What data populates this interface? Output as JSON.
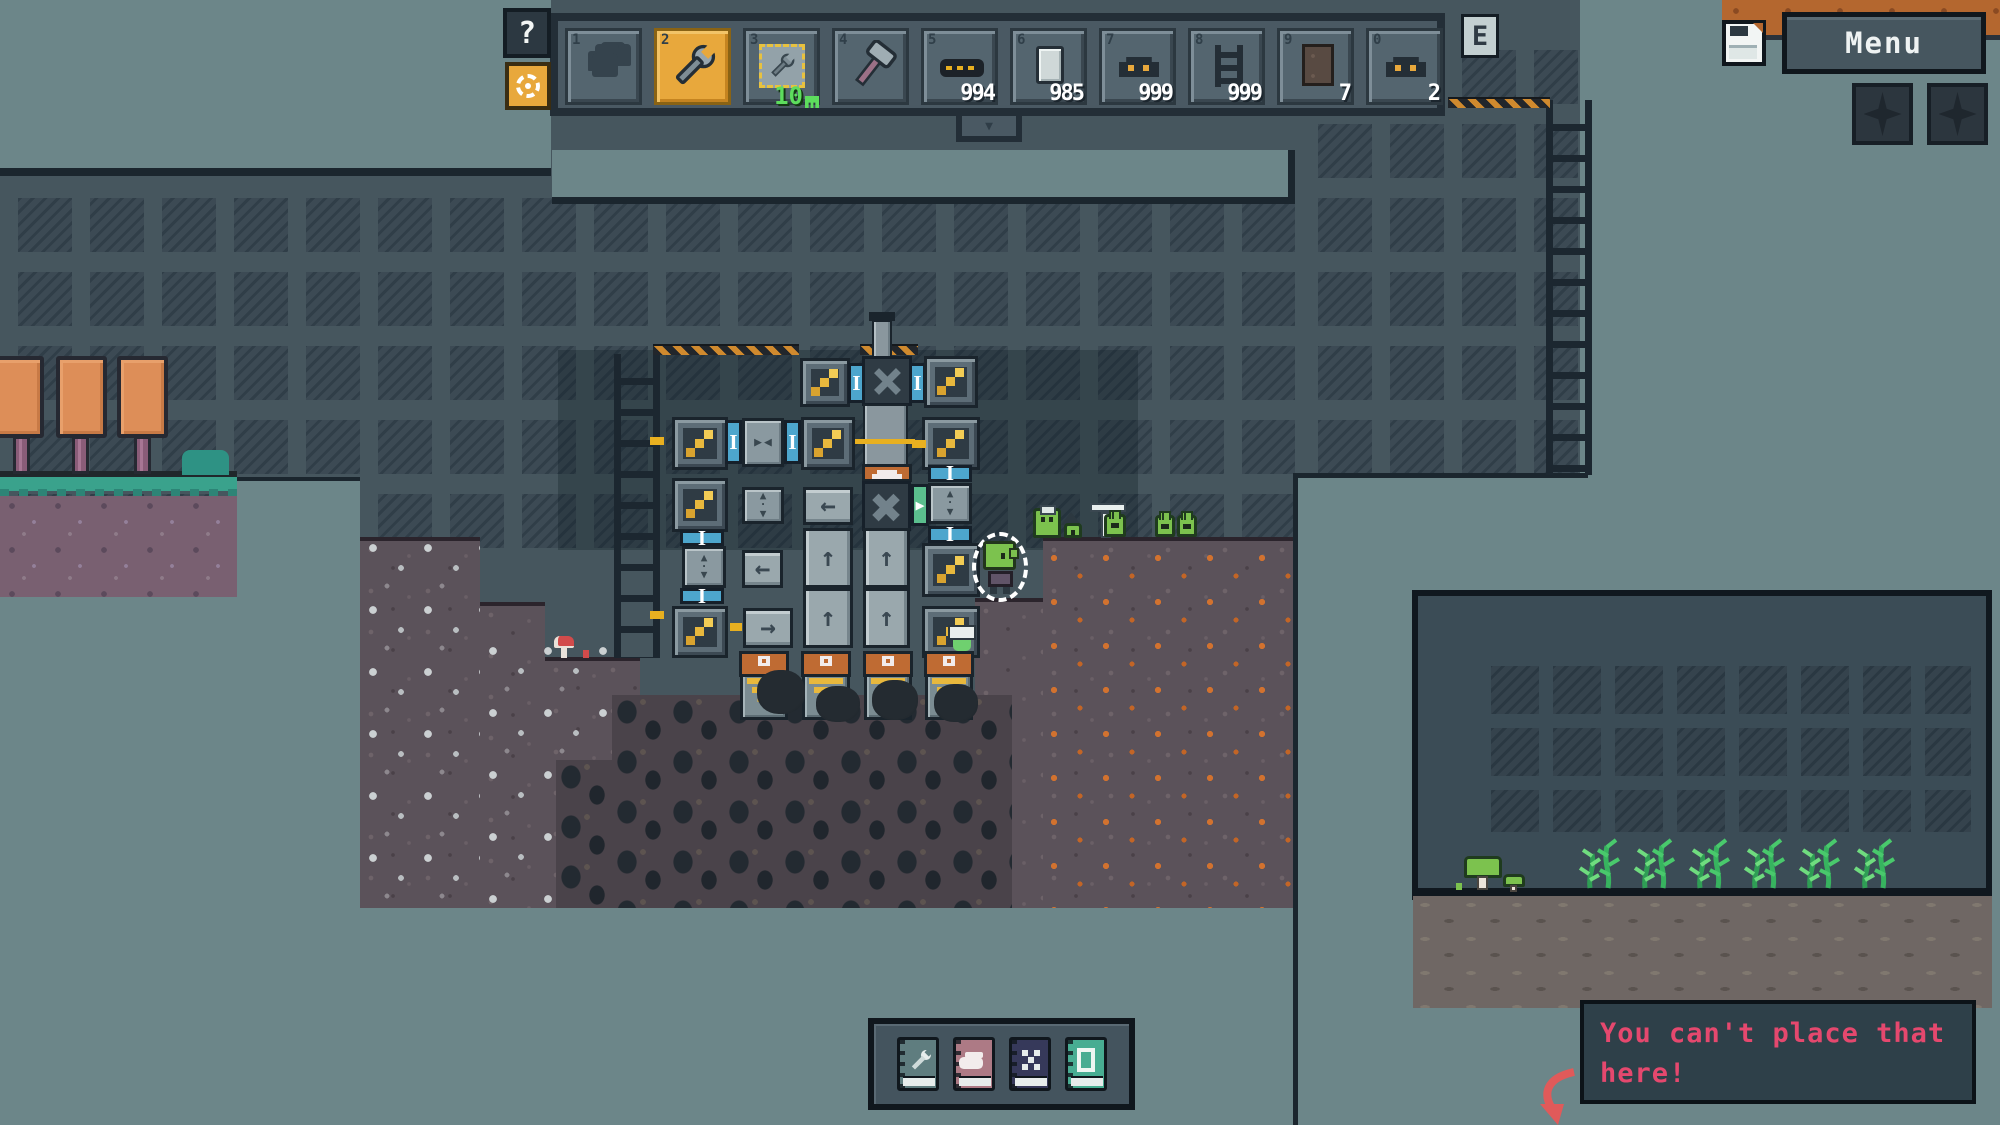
{
  "colors": {
    "sky": "#6c8689",
    "underground": "#46565e",
    "selected_slot": "#e8a83c",
    "toast_text": "#e5486e",
    "blueprint_badge_green": "#5ddd5d",
    "hazard_orange": "#d08a2e",
    "connector_blue": "#4da6cd",
    "connector_green": "#5bbf8e",
    "ore_orange": "#d2722f"
  },
  "glyphs": {
    "up": "↑",
    "left": "←",
    "right": "→",
    "tab_down": "▼",
    "port": "I",
    "output": "▶",
    "sort_up": "▲",
    "sort_down": "▼",
    "valve_left": "▶",
    "valve_right": "◀",
    "dot": "·"
  },
  "hud": {
    "help_button": "?",
    "hotbar_hotkey_badge": "E",
    "menu_button": "Menu",
    "hotbar": {
      "selected_index": 1,
      "slots": [
        {
          "key": "1",
          "item": "hand",
          "count": ""
        },
        {
          "key": "2",
          "item": "wrench",
          "count": ""
        },
        {
          "key": "3",
          "item": "blueprint",
          "count": "",
          "badge": "10"
        },
        {
          "key": "4",
          "item": "hammer",
          "count": ""
        },
        {
          "key": "5",
          "item": "conveyor",
          "count": "994"
        },
        {
          "key": "6",
          "item": "metal-plate",
          "count": "985"
        },
        {
          "key": "7",
          "item": "miner-machine",
          "count": "999"
        },
        {
          "key": "8",
          "item": "ladder",
          "count": "999"
        },
        {
          "key": "9",
          "item": "wall-panel",
          "count": "7"
        },
        {
          "key": "0",
          "item": "machine",
          "count": "2"
        }
      ]
    }
  },
  "toast": {
    "line1": "You can't place that",
    "line2": "here!"
  },
  "books": [
    {
      "icon": "wrench-book"
    },
    {
      "icon": "furnace-book"
    },
    {
      "icon": "pixel-grid-book"
    },
    {
      "icon": "frame-book"
    }
  ]
}
